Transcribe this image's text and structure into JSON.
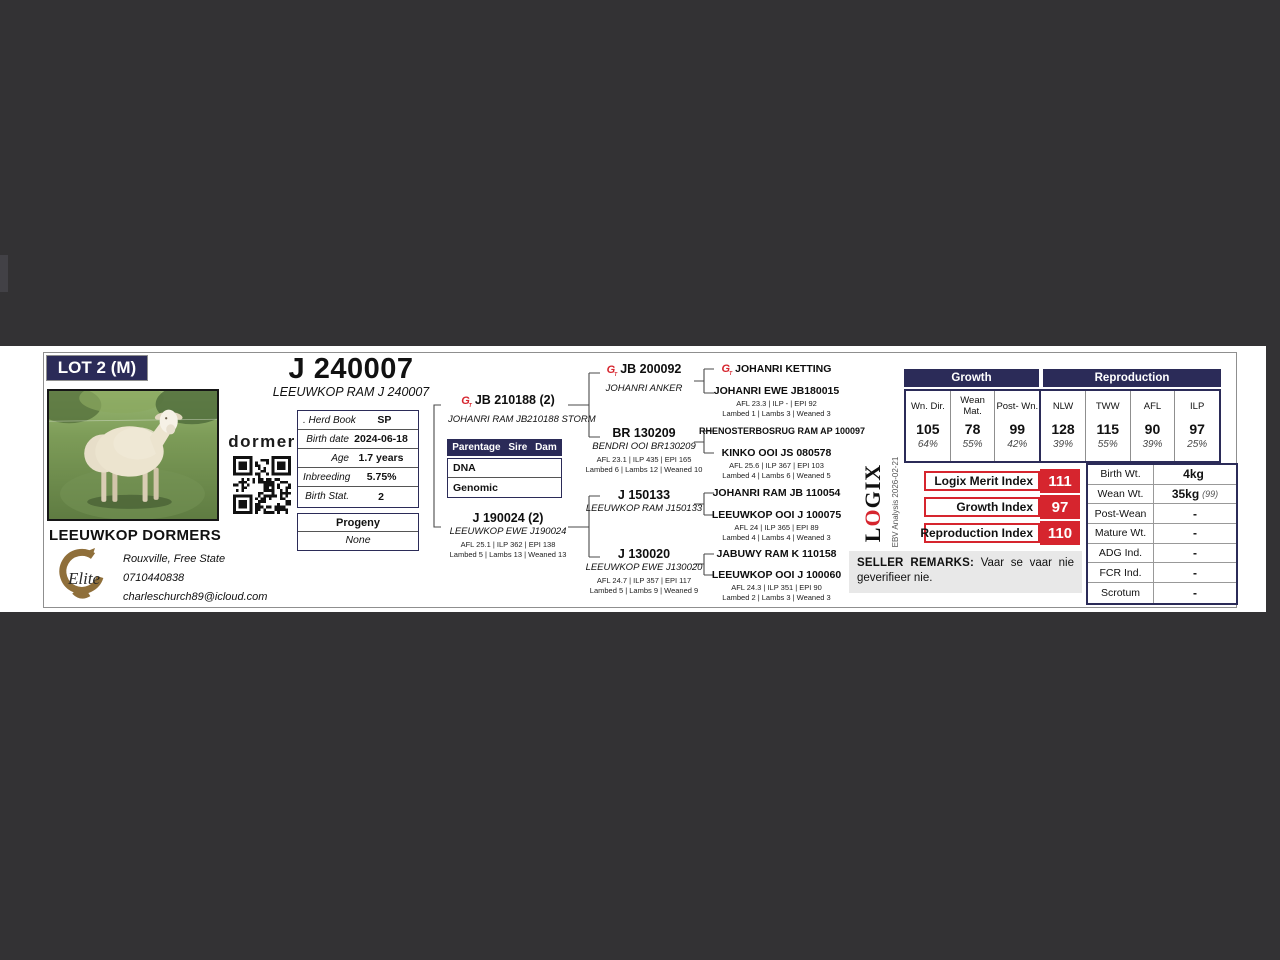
{
  "colors": {
    "navy": "#2b2b58",
    "red": "#d6252e"
  },
  "lot": {
    "badge": "LOT 2 (M)"
  },
  "header": {
    "title": "J 240007",
    "subtitle": "LEEUWKOP RAM J 240007"
  },
  "brand": {
    "dormer": "dormer"
  },
  "icons": {
    "genomic": "G",
    "qr": "qr-code",
    "elite": "elite-breeders-emblem",
    "photo": "ram-photo"
  },
  "info": {
    "rows": [
      {
        "label": ". Herd Book",
        "value": "SP"
      },
      {
        "label": "Birth date",
        "value": "2024-06-18"
      },
      {
        "label": "Age",
        "value": "1.7 years"
      },
      {
        "label": "Inbreeding",
        "value": "5.75%"
      },
      {
        "label": "Birth Stat.",
        "value": "2"
      }
    ]
  },
  "progeny": {
    "header": "Progeny",
    "value": "None"
  },
  "parentage": {
    "header": "Parentage Sire Dam",
    "row1": "DNA",
    "row2": "Genomic"
  },
  "owner": {
    "name": "LEEUWKOP DORMERS",
    "location": "Rouxville, Free State",
    "phone": "0710440838",
    "email": "charleschurch89@icloud.com"
  },
  "pedigree": {
    "sire": {
      "id": "JB 210188 (2)",
      "name": "JOHANRI RAM JB210188 STORM"
    },
    "dam": {
      "id": "J 190024 (2)",
      "name": "LEEUWKOP EWE J190024",
      "s1": "AFL 25.1 | ILP 362 | EPI 138",
      "s2": "Lambed 5 | Lambs 13 | Weaned 13"
    },
    "gen2": [
      {
        "id": "JB 200092",
        "name": "JOHANRI ANKER"
      },
      {
        "id": "BR 130209",
        "name": "BENDRI OOI BR130209",
        "s1": "AFL 23.1 | ILP 435 | EPI 165",
        "s2": "Lambed 6 | Lambs 12 | Weaned 10"
      },
      {
        "id": "J 150133",
        "name": "LEEUWKOP RAM J150133"
      },
      {
        "id": "J 130020",
        "name": "LEEUWKOP EWE J130020",
        "s1": "AFL 24.7 | ILP 357 | EPI 117",
        "s2": "Lambed 5 | Lambs 9 | Weaned 9"
      }
    ],
    "gen3": [
      {
        "id": "JOHANRI KETTING"
      },
      {
        "id": "JOHANRI EWE JB180015",
        "s1": "AFL 23.3 | ILP - | EPI 92",
        "s2": "Lambed 1 | Lambs 3 | Weaned 3"
      },
      {
        "id": "RHENOSTERBOSRUG RAM AP 100097"
      },
      {
        "id": "KINKO OOI JS 080578",
        "s1": "AFL 25.6 | ILP 367 | EPI 103",
        "s2": "Lambed 4 | Lambs 6 | Weaned 5"
      },
      {
        "id": "JOHANRI RAM JB 110054"
      },
      {
        "id": "LEEUWKOP OOI J 100075",
        "s1": "AFL 24 | ILP 365 | EPI 89",
        "s2": "Lambed 4 | Lambs 4 | Weaned 3"
      },
      {
        "id": "JABUWY RAM K 110158"
      },
      {
        "id": "LEEUWKOP OOI J 100060",
        "s1": "AFL 24.3 | ILP 351 | EPI 90",
        "s2": "Lambed 2 | Lambs 3 | Weaned 3"
      }
    ]
  },
  "ebv": {
    "growth_header": "Growth",
    "repro_header": "Reproduction",
    "cols": [
      {
        "h": "Wn. Dir.",
        "v": "105",
        "p": "64%"
      },
      {
        "h": "Wean Mat.",
        "v": "78",
        "p": "55%"
      },
      {
        "h": "Post- Wn.",
        "v": "99",
        "p": "42%"
      },
      {
        "h": "NLW",
        "v": "128",
        "p": "39%"
      },
      {
        "h": "TWW",
        "v": "115",
        "p": "55%"
      },
      {
        "h": "AFL",
        "v": "90",
        "p": "39%"
      },
      {
        "h": "ILP",
        "v": "97",
        "p": "25%"
      }
    ]
  },
  "logix": {
    "l": "L",
    "o": "O",
    "gix": "GIX",
    "analysis": "EBV Analysis 2026-02-21"
  },
  "indexes": [
    {
      "label": "Logix Merit Index",
      "value": "111"
    },
    {
      "label": "Growth Index",
      "value": "97"
    },
    {
      "label": "Reproduction Index",
      "value": "110"
    }
  ],
  "remarks": {
    "label": "SELLER REMARKS:",
    "text": "Vaar se vaar nie geverifieer nie."
  },
  "weights": {
    "rows": [
      {
        "label": "Birth Wt.",
        "value": "4kg"
      },
      {
        "label": "Wean Wt.",
        "value": "35kg",
        "note": "(99)"
      },
      {
        "label": "Post-Wean",
        "value": "-"
      },
      {
        "label": "Mature Wt.",
        "value": "-"
      },
      {
        "label": "ADG Ind.",
        "value": "-"
      },
      {
        "label": "FCR Ind.",
        "value": "-"
      },
      {
        "label": "Scrotum",
        "value": "-"
      }
    ]
  }
}
